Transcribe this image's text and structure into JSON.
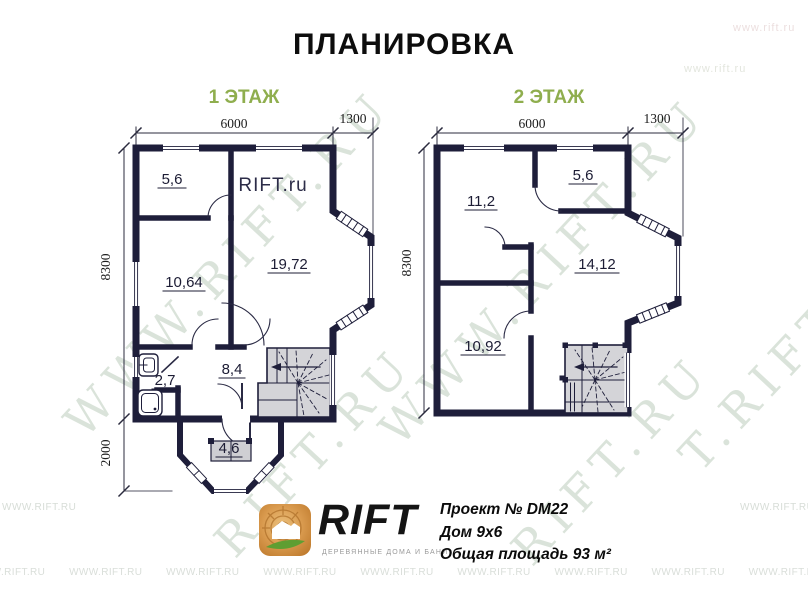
{
  "title": "ПЛАНИРОВКА",
  "floor1": {
    "label": "1 ЭТАЖ",
    "dim_width": "6000",
    "dim_bay": "1300",
    "dim_height": "8300",
    "dim_porch": "2000",
    "inner_watermark": "RIFT.ru",
    "areas": {
      "room_top_left": "5,6",
      "room_mid_left": "10,64",
      "living_room": "19,72",
      "bathroom": "2,7",
      "hall": "8,4",
      "porch": "4,6"
    }
  },
  "floor2": {
    "label": "2 ЭТАЖ",
    "dim_width": "6000",
    "dim_bay": "1300",
    "dim_height": "8300",
    "areas": {
      "room_top_left": "11,2",
      "room_top_right": "5,6",
      "room_right": "14,12",
      "room_bottom_left": "10,92"
    }
  },
  "footer": {
    "brand": "RIFT",
    "tagline": "ДЕРЕВЯННЫЕ ДОМА И БАНИ",
    "project": "Проект № DM22",
    "house": "Дом 9х6",
    "area_total": "Общая площадь 93 м²"
  },
  "watermarks": {
    "site_small": "WWW.RIFT.RU",
    "site_plain": "www.rift.ru",
    "diag1": "WWW.RIFT.RU",
    "diag2": "RIFT.RU",
    "diag3": "WWW.RIFT.RU",
    "diag4": "RIFT.RU",
    "diag5": "T.RIFT.RU"
  },
  "colors": {
    "wall": "#1e1e3a",
    "stairs_fill": "#d4d4d8",
    "floor_label": "#8fae4e",
    "watermark": "#b7c9b7",
    "logo_wood": "#d99a4e",
    "logo_leaf": "#5f9e32"
  }
}
